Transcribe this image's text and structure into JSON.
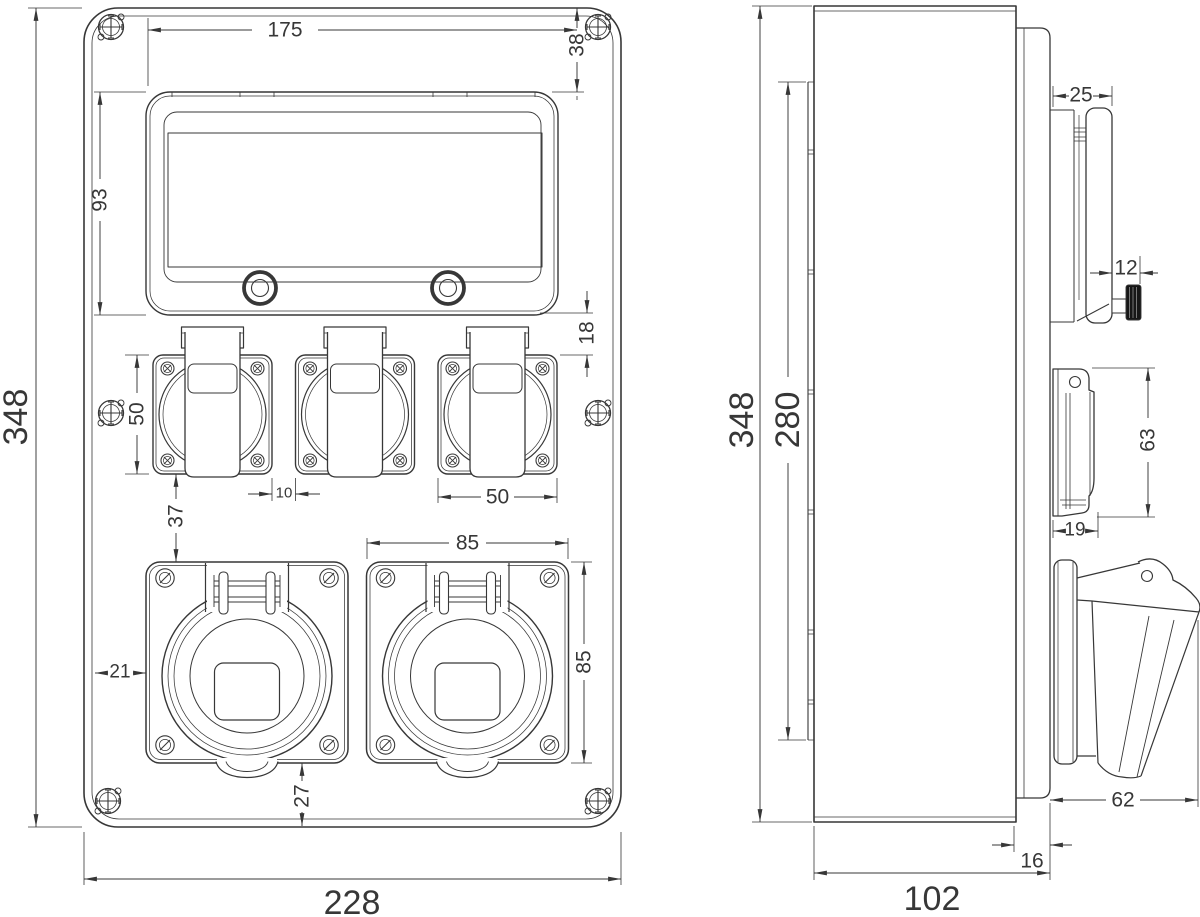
{
  "colors": {
    "ink": "#373737",
    "knob": "#161616",
    "paper": "#ffffff"
  },
  "front_view": {
    "dims": {
      "overall_width": "228",
      "overall_height": "348",
      "window_width": "175",
      "window_offset_top": "38",
      "window_height": "93",
      "window_to_sockets": "18",
      "socket_height": "50",
      "socket_width": "50",
      "socket_gap": "10",
      "sockets_to_cee": "37",
      "cee_offset_left": "21",
      "cee_width": "85",
      "cee_height": "85",
      "cee_offset_bottom": "27"
    }
  },
  "side_view": {
    "dims": {
      "overall_height": "348",
      "mount_height": "280",
      "overall_depth": "102",
      "cover_depth": "25",
      "knob_depth": "12",
      "socket_height": "63",
      "socket_depth": "19",
      "cee_depth": "62",
      "front_depth": "16"
    }
  }
}
